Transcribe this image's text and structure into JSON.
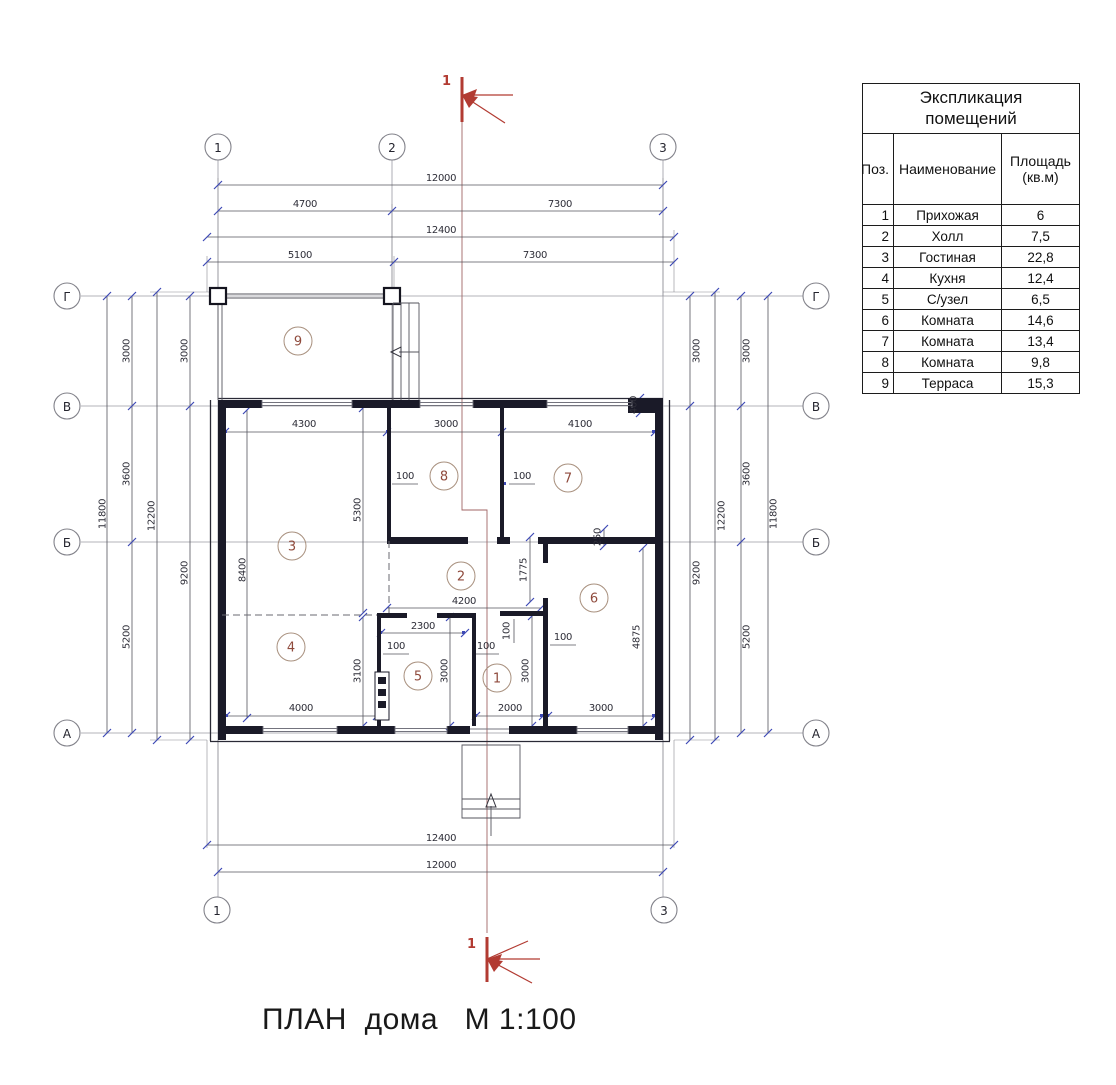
{
  "drawing_title": "ПЛАН  дома   М 1:100",
  "section_label": "1",
  "table": {
    "title1": "Экспликация",
    "title2": "помещений",
    "col_pos": "Поз.",
    "col_name": "Наименование",
    "col_area": "Площадь (кв.м)",
    "rows": [
      {
        "pos": "1",
        "name": "Прихожая",
        "area": "6"
      },
      {
        "pos": "2",
        "name": "Холл",
        "area": "7,5"
      },
      {
        "pos": "3",
        "name": "Гостиная",
        "area": "22,8"
      },
      {
        "pos": "4",
        "name": "Кухня",
        "area": "12,4"
      },
      {
        "pos": "5",
        "name": "С/узел",
        "area": "6,5"
      },
      {
        "pos": "6",
        "name": "Комната",
        "area": "14,6"
      },
      {
        "pos": "7",
        "name": "Комната",
        "area": "13,4"
      },
      {
        "pos": "8",
        "name": "Комната",
        "area": "9,8"
      },
      {
        "pos": "9",
        "name": "Терраса",
        "area": "15,3"
      }
    ]
  },
  "axes": {
    "a1": "1",
    "a2": "2",
    "a3": "3",
    "ag": "Г",
    "av": "В",
    "ab": "Б",
    "aa": "А"
  },
  "rooms": {
    "r1": "1",
    "r2": "2",
    "r3": "3",
    "r4": "4",
    "r5": "5",
    "r6": "6",
    "r7": "7",
    "r8": "8",
    "r9": "9"
  },
  "dims": {
    "d12000": "12000",
    "d4700": "4700",
    "d7300": "7300",
    "d12400": "12400",
    "d5100": "5100",
    "d11800": "11800",
    "d3000": "3000",
    "d3600": "3600",
    "d5200": "5200",
    "d12200": "12200",
    "d9200": "9200",
    "d4300": "4300",
    "d4100": "4100",
    "d400": "400",
    "d100": "100",
    "d5300": "5300",
    "d8400": "8400",
    "d250": "250",
    "d1775": "1775",
    "d4200": "4200",
    "d2300": "2300",
    "d3100": "3100",
    "d4875": "4875",
    "d4000": "4000",
    "d2000": "2000"
  },
  "colors": {
    "wall": "#1a1a28",
    "dim_line": "#55555e",
    "tick": "#3d49b5",
    "section_red": "#b23b32",
    "room_number": "#8f4a3c"
  }
}
